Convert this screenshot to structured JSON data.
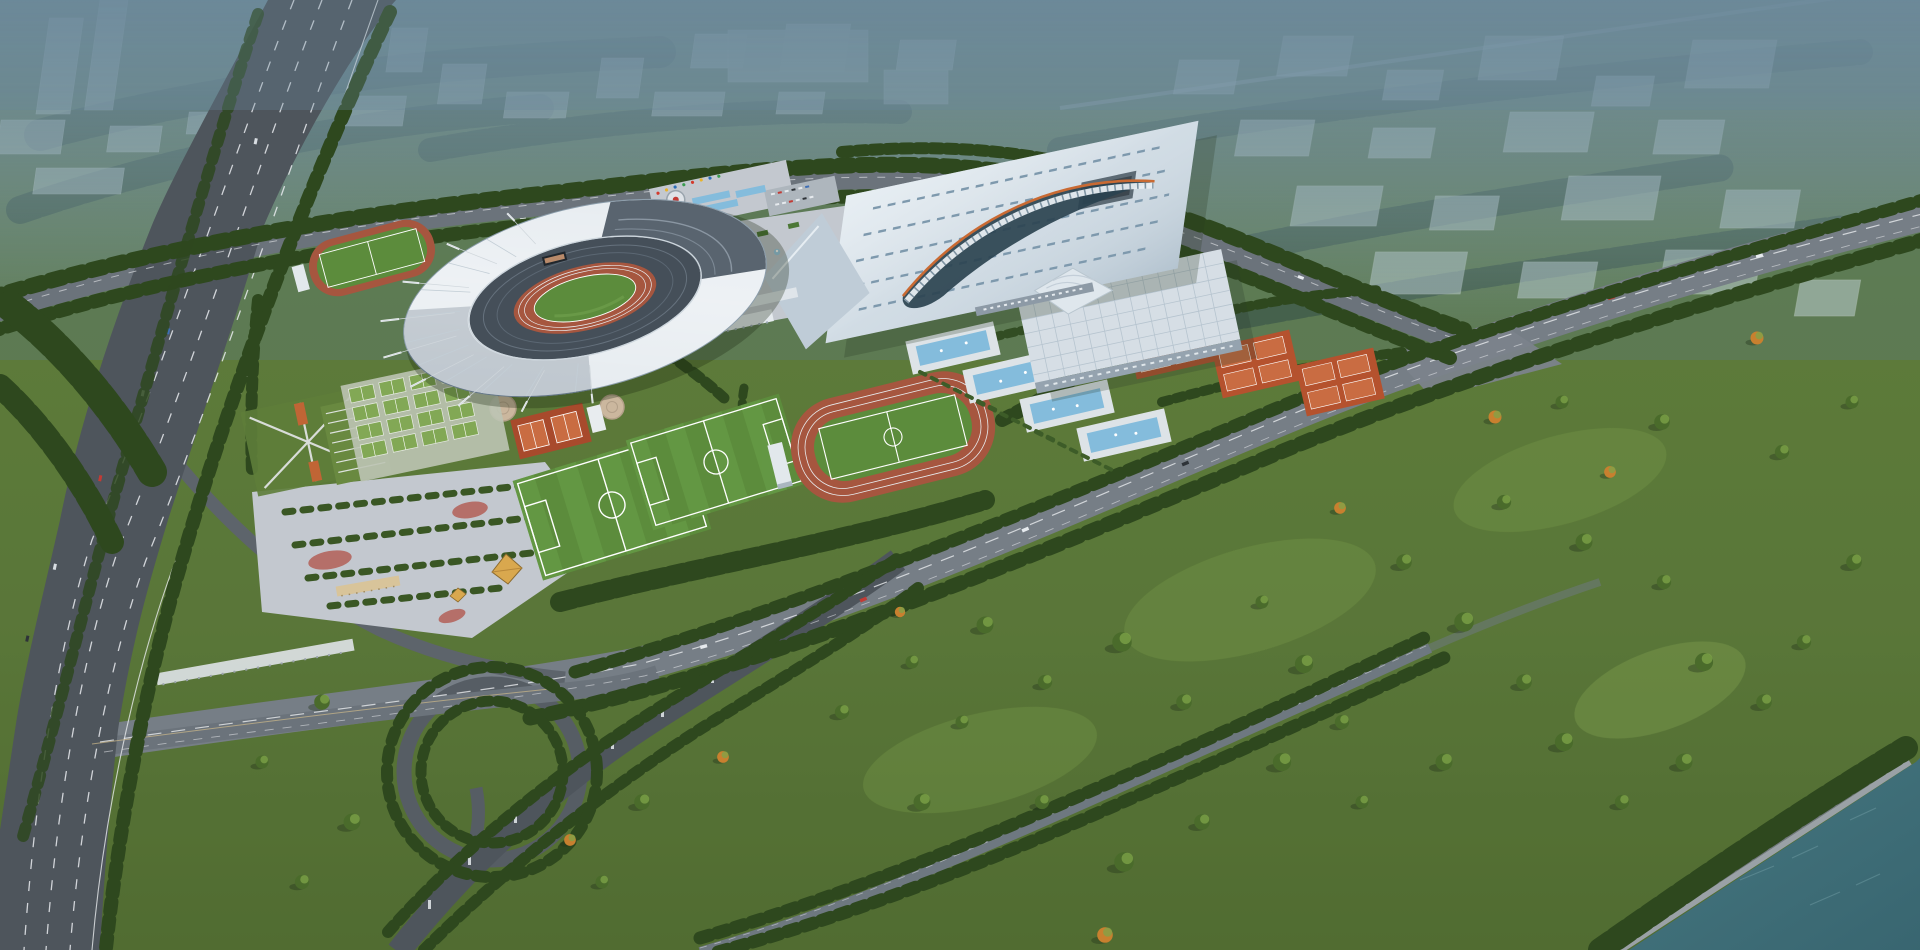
{
  "scene": {
    "type": "aerial-architectural-rendering",
    "subject": "sports-complex-masterplan-with-stadium-and-interchange"
  },
  "palette": {
    "haze_blue": "#7490a3",
    "city_block": "#c5d4db",
    "meadow_green": "#5e7d3a",
    "lawn_light": "#739647",
    "tree_dark": "#2e481e",
    "tree_mid": "#4a6b2b",
    "autumn_orange": "#c8802f",
    "asphalt_dark": "#4e555c",
    "asphalt_mid": "#6b737b",
    "asphalt_light": "#767e86",
    "concrete_plaza": "#c3c8cf",
    "stadium_roof_white": "#e3e9ee",
    "stadium_bowl": "#454f59",
    "running_track_red": "#a6563f",
    "pitch_green": "#5c8c3c",
    "tennis_clay_orange": "#b5522e",
    "clay_court_light": "#c96c42",
    "pool_water_blue": "#84bcdc",
    "pool_deck": "#dde3e7",
    "hall_roof": "#c9d6e0",
    "hall2_roof": "#d6dee5",
    "river_teal": "#3f6e78",
    "lane_marking": "#e9ebee",
    "gold_roof": "#d9a84e"
  },
  "facilities": [
    "main-stadium",
    "gymnasium-hall",
    "training-hall",
    "outdoor-tennis-courts",
    "aquatic-terrace-pools",
    "athletics-track",
    "practice-track",
    "football-pitches",
    "basketball-court-grid",
    "entrance-plaza",
    "central-fountain-plaza",
    "south-parking-plaza",
    "highway-interchange",
    "riverfront-park",
    "city-backdrop"
  ]
}
